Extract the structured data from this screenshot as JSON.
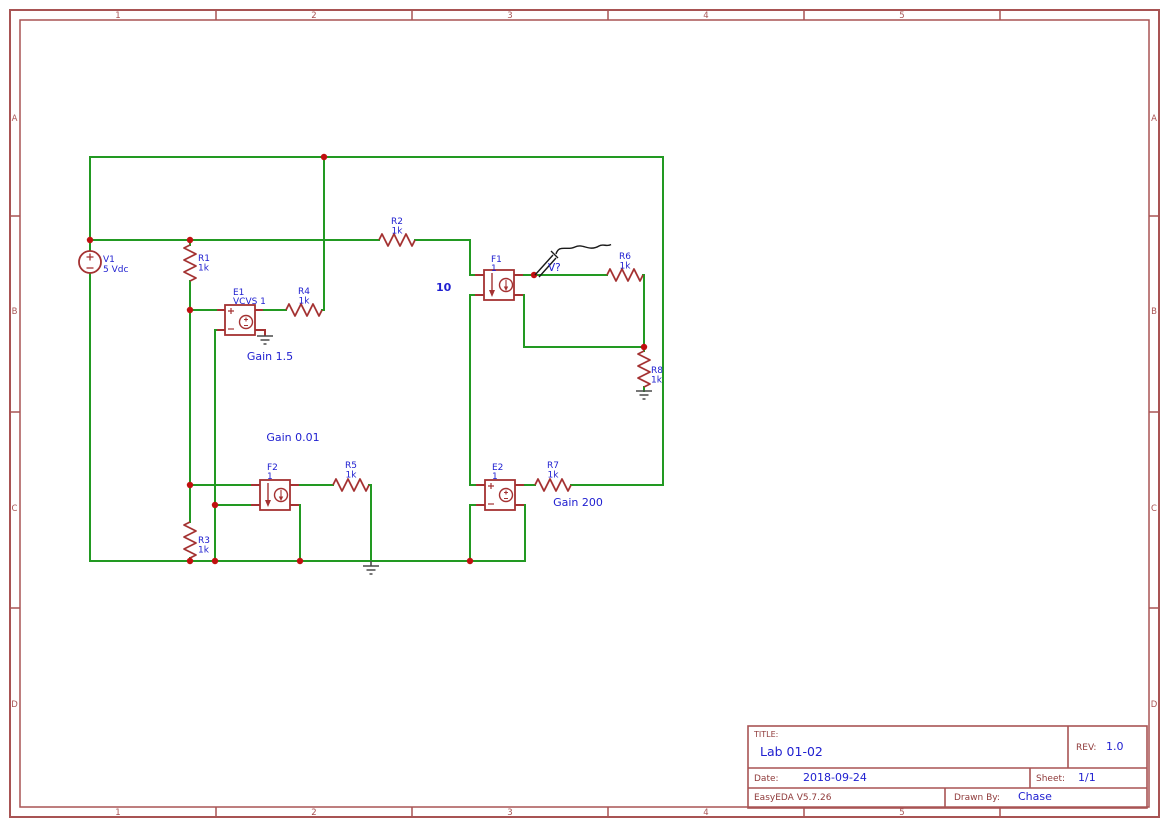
{
  "frame": {
    "columns": [
      "1",
      "2",
      "3",
      "4",
      "5"
    ],
    "rows": [
      "A",
      "B",
      "C",
      "D"
    ]
  },
  "title_block": {
    "title_label": "TITLE:",
    "title": "Lab 01-02",
    "rev_label": "REV:",
    "rev": "1.0",
    "date_label": "Date:",
    "date": "2018-09-24",
    "sheet_label": "Sheet:",
    "sheet": "1/1",
    "software": "EasyEDA V5.7.26",
    "drawn_by_label": "Drawn By:",
    "drawn_by": "Chase"
  },
  "components": {
    "V1": {
      "ref": "V1",
      "value": "5 Vdc"
    },
    "R1": {
      "ref": "R1",
      "value": "1k"
    },
    "R2": {
      "ref": "R2",
      "value": "1k"
    },
    "R3": {
      "ref": "R3",
      "value": "1k"
    },
    "R4": {
      "ref": "R4",
      "value": "1k"
    },
    "R5": {
      "ref": "R5",
      "value": "1k"
    },
    "R6": {
      "ref": "R6",
      "value": "1k"
    },
    "R7": {
      "ref": "R7",
      "value": "1k"
    },
    "R8": {
      "ref": "R8",
      "value": "1k"
    },
    "E1": {
      "ref": "E1",
      "value": "VCVS 1",
      "gain_label": "Gain 1.5"
    },
    "E2": {
      "ref": "E2",
      "value": "1",
      "gain_label": "Gain 200"
    },
    "F1": {
      "ref": "F1",
      "value": "1",
      "gain_label": "10"
    },
    "F2": {
      "ref": "F2",
      "value": "1",
      "gain_label": "Gain 0.01"
    }
  },
  "probe": {
    "label": "V?"
  },
  "colors": {
    "wire_green": "#229922",
    "component_maroon": "#a43232",
    "frame_maroon": "#a85454",
    "label_blue": "#2020d0",
    "junction_red": "#c01010",
    "ground_gray": "#4a4a4a",
    "probe_black": "#1a1a1a",
    "background": "#ffffff"
  }
}
